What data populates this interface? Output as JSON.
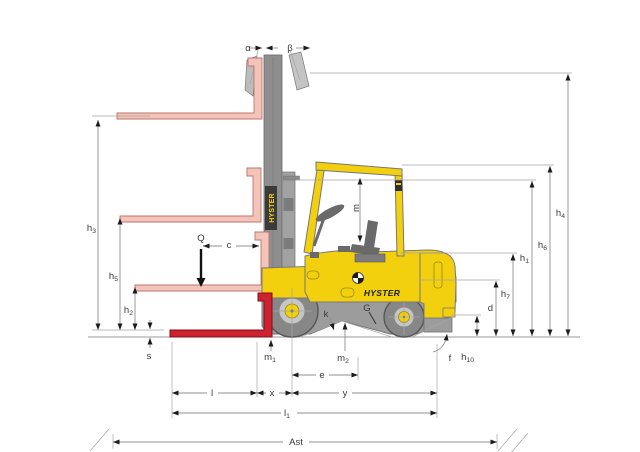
{
  "diagram_type": "forklift-dimension-diagram",
  "brand": {
    "side_logo": "HYSTER",
    "mast_logo": "HYSTER"
  },
  "labels": {
    "alpha": "α",
    "beta": "β",
    "load": "Q",
    "load_center": "c",
    "h1": {
      "base": "h",
      "sub": "1"
    },
    "h2": {
      "base": "h",
      "sub": "2"
    },
    "h3": {
      "base": "h",
      "sub": "3"
    },
    "h4": {
      "base": "h",
      "sub": "4"
    },
    "h5": {
      "base": "h",
      "sub": "5"
    },
    "h6": {
      "base": "h",
      "sub": "6"
    },
    "h7": {
      "base": "h",
      "sub": "7"
    },
    "h10": {
      "base": "h",
      "sub": "10"
    },
    "s": "s",
    "d": "d",
    "k": "k",
    "g": "G",
    "f": "f",
    "m_headroom": "m",
    "m1": {
      "base": "m",
      "sub": "1"
    },
    "m2": {
      "base": "m",
      "sub": "2"
    },
    "e": "e",
    "l": "l",
    "x": "x",
    "y": "y",
    "l1": {
      "base": "l",
      "sub": "1"
    },
    "ast": "Ast"
  },
  "colors": {
    "body_yellow": "#F2D00E",
    "fork_red": "#CE2231",
    "fork_pink": "#F3C4BA",
    "chassis_gray": "#9C9C9C",
    "mast_gray": "#8E8E8E",
    "dim_line_gray": "#8F8F8F",
    "label_gray": "#3A3A3A"
  }
}
